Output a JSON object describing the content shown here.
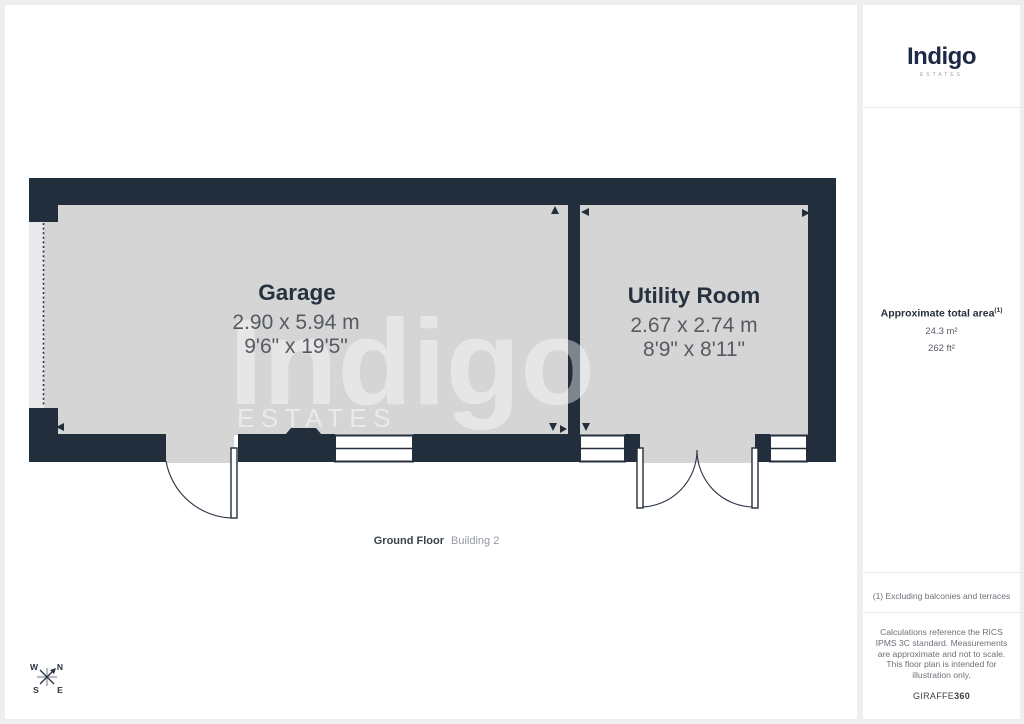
{
  "colors": {
    "wall": "#232e3c",
    "floor": "#d5d5d5",
    "room_label": "#273240",
    "dimension_text": "#565b63",
    "brand_navy": "#1d2946",
    "page_background": "#edeeee"
  },
  "main": {
    "watermark": {
      "name": "Indigo",
      "sub": "ESTATES"
    },
    "plan": {
      "rooms": [
        {
          "name": "Garage",
          "dimensions_metric": "2.90 x 5.94 m",
          "dimensions_imperial": "9'6\" x 19'5\""
        },
        {
          "name": "Utility Room",
          "dimensions_metric": "2.67 x 2.74 m",
          "dimensions_imperial": "8'9\" x 8'11\""
        }
      ],
      "floor_label": "Ground Floor",
      "building_label": "Building 2"
    },
    "compass": {
      "w": "W",
      "n": "N",
      "s": "S",
      "e": "E"
    }
  },
  "sidebar": {
    "logo": {
      "name": "Indigo",
      "sub": "ESTATES"
    },
    "area": {
      "title": "Approximate total area",
      "superscript": "(1)",
      "metric": "24.3 m²",
      "imperial": "262 ft²"
    },
    "footnote": "(1) Excluding balconies and terraces",
    "disclaimer": "Calculations reference the RICS IPMS 3C standard. Measurements are approximate and not to scale. This floor plan is intended for illustration only.",
    "provider": {
      "name": "GIRAFFE",
      "suffix": "360"
    }
  }
}
